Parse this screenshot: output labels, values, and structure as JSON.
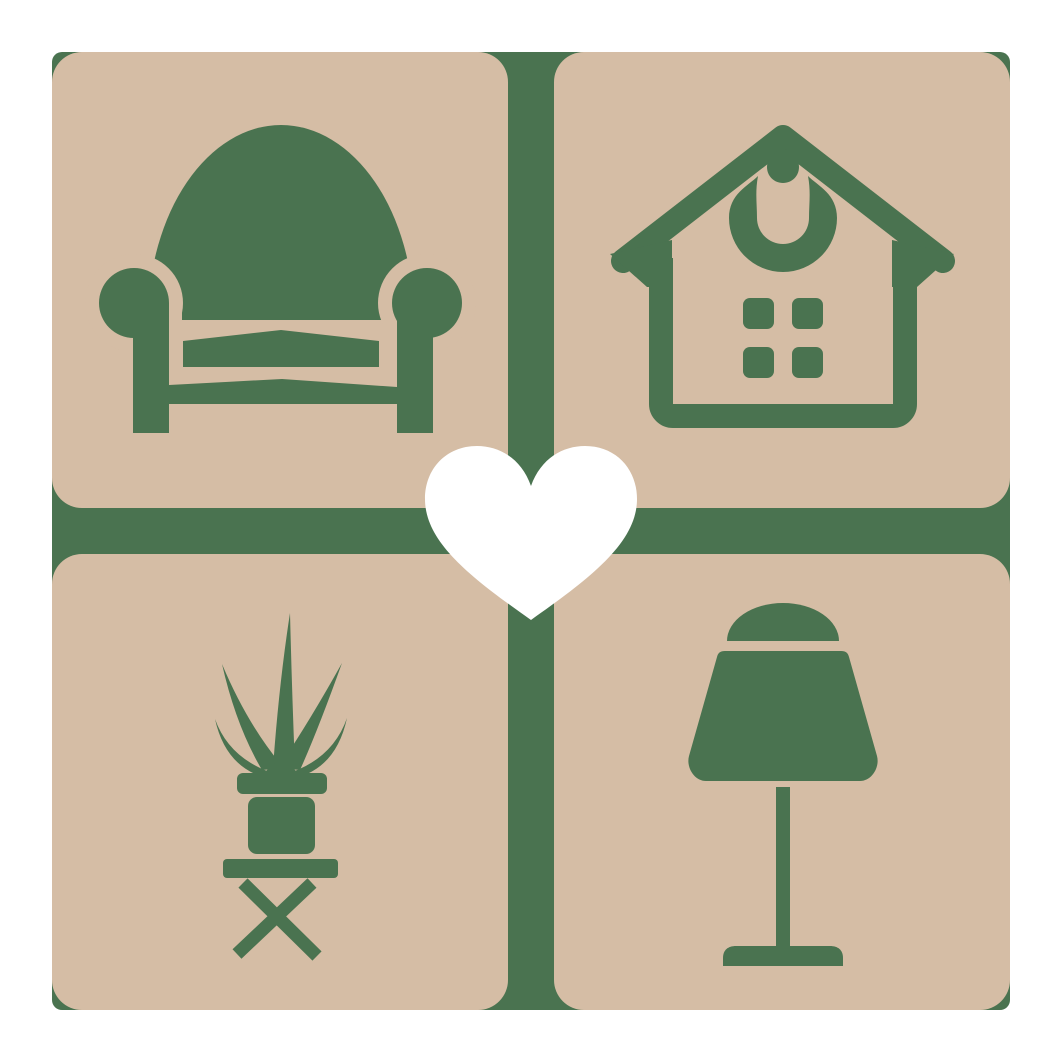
{
  "logo": {
    "name": "home-furniture-love-logo",
    "colors": {
      "page": "#ffffff",
      "tile": "#d5bda5",
      "icon": "#4a7350",
      "heart": "#ffffff"
    },
    "grid": {
      "rows": 2,
      "columns": 2
    },
    "tiles": [
      {
        "id": "armchair",
        "position": "top-left",
        "icon": "armchair-icon"
      },
      {
        "id": "house",
        "position": "top-right",
        "icon": "house-icon"
      },
      {
        "id": "potted-plant",
        "position": "bottom-left",
        "icon": "potted-plant-icon"
      },
      {
        "id": "table-lamp",
        "position": "bottom-right",
        "icon": "table-lamp-icon"
      }
    ],
    "center_overlay": {
      "id": "heart",
      "icon": "heart-icon"
    }
  }
}
